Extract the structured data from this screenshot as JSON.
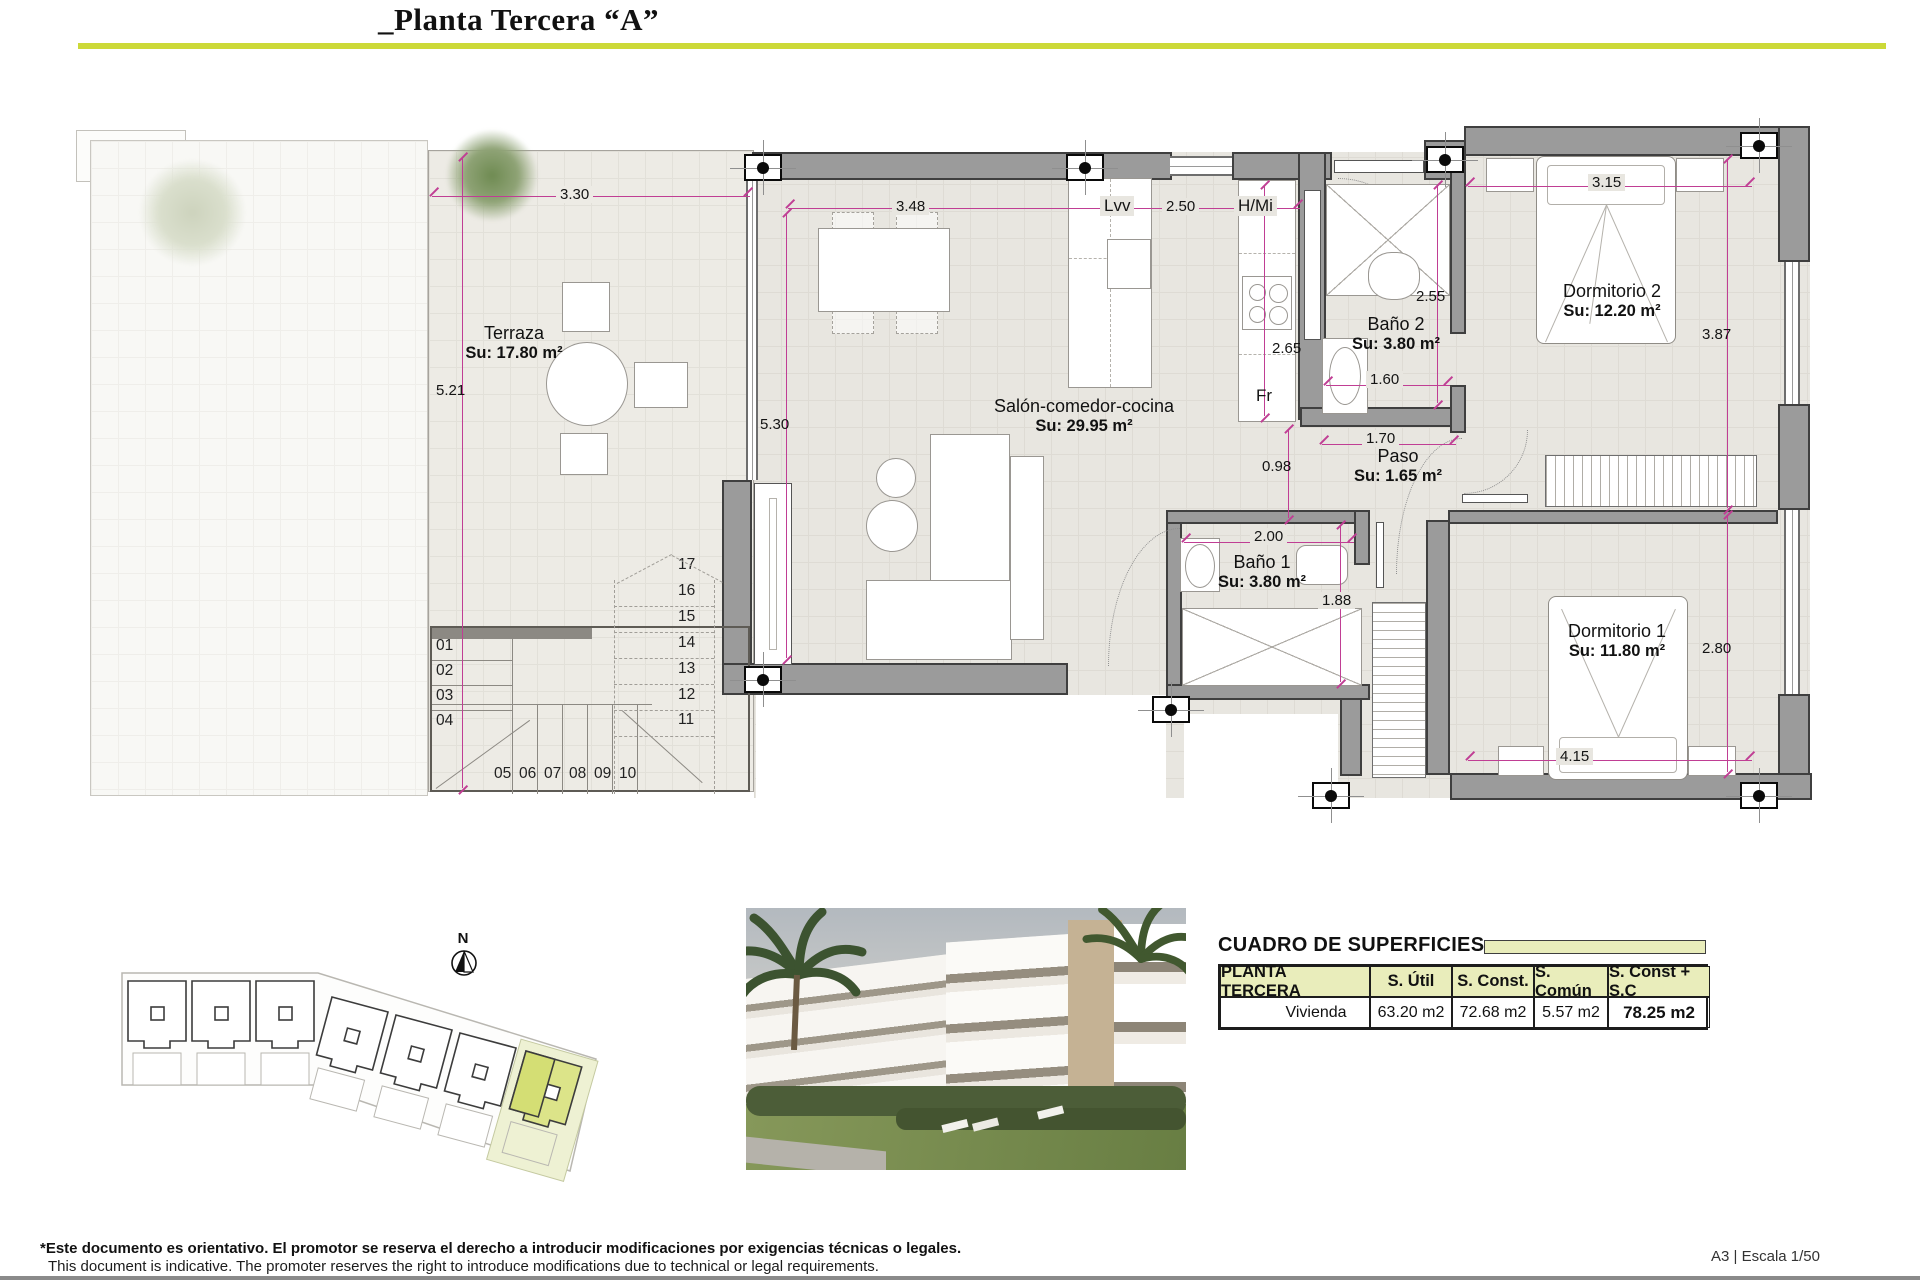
{
  "header": {
    "title": "_Planta Tercera “A”"
  },
  "plan": {
    "rooms": {
      "terraza": {
        "name": "Terraza",
        "area": "Su: 17.80 m²"
      },
      "salon": {
        "name": "Salón-comedor-cocina",
        "area": "Su: 29.95 m²"
      },
      "bano2": {
        "name": "Baño 2",
        "area": "Su: 3.80 m²"
      },
      "paso": {
        "name": "Paso",
        "area": "Su: 1.65 m²"
      },
      "bano1": {
        "name": "Baño 1",
        "area": "Su: 3.80 m²"
      },
      "dorm2": {
        "name": "Dormitorio 2",
        "area": "Su: 12.20 m²"
      },
      "dorm1": {
        "name": "Dormitorio 1",
        "area": "Su: 11.80 m²"
      }
    },
    "appliances": {
      "dishwasher": "Lvv",
      "washer_column": "H/Mi",
      "fridge": "Fr"
    },
    "dims": {
      "terraza_width": "3.30",
      "terraza_depth": "5.21",
      "salon_width": "3.48",
      "kitchen_width": "2.50",
      "salon_depth": "5.30",
      "kitchen_depth": "2.65",
      "bano2_depth": "2.55",
      "bano2_width": "1.60",
      "paso_width": "1.70",
      "paso_clear": "0.98",
      "bano1_width": "2.00",
      "bano1_depth": "1.88",
      "dorm2_width": "3.15",
      "dorm2_depth": "3.87",
      "dorm1_depth": "2.80",
      "dorm1_width": "4.15"
    },
    "stairs": {
      "left": [
        "01",
        "02",
        "03",
        "04"
      ],
      "bottom": [
        "05",
        "06",
        "07",
        "08",
        "09",
        "10"
      ],
      "right": [
        "17",
        "16",
        "15",
        "14",
        "13",
        "12",
        "11"
      ]
    }
  },
  "site_plan": {
    "north_label": "N"
  },
  "surfaces": {
    "title": "CUADRO DE SUPERFICIES",
    "headers": [
      "PLANTA TERCERA",
      "S. Útil",
      "S. Const.",
      "S. Común",
      "S. Const + S.C"
    ],
    "row": {
      "unit": "Vivienda",
      "util": "63.20 m2",
      "construida": "72.68 m2",
      "comun": "5.57 m2",
      "total": "78.25 m2"
    }
  },
  "footer": {
    "es": "*Este documento es orientativo. El promotor se reserva el derecho a introducir modificaciones por exigencias técnicas o legales.",
    "en": "This document is indicative. The promoter reserves the right to introduce modifications due to technical or legal requirements.",
    "sheet": "A3 | Escala 1/50"
  },
  "colors": {
    "accent_line": "#ccd938",
    "table_header_bg": "#e9edbb",
    "highlight_unit": "#dce489",
    "dimension_magenta": "#c03e94"
  }
}
